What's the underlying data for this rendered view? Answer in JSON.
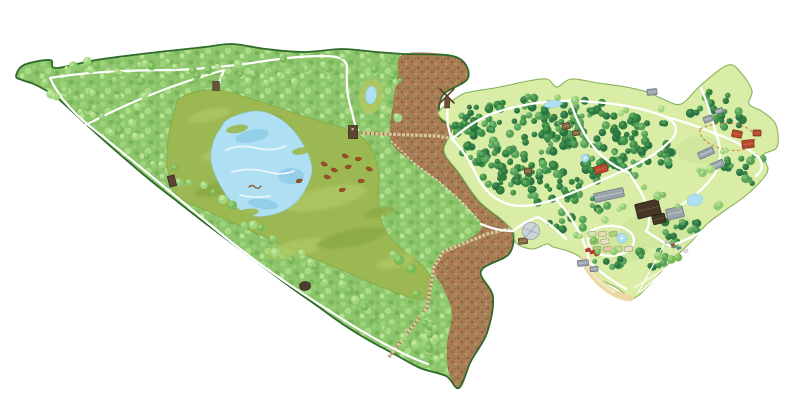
{
  "map": {
    "name": "illustrated-nature-reserve-and-wildlife-park-map",
    "background": "#ffffff",
    "features": [
      {
        "name": "nature-reserve-forest",
        "type": "region"
      },
      {
        "name": "bog-marsh",
        "type": "region"
      },
      {
        "name": "lake",
        "type": "water"
      },
      {
        "name": "forest-pond",
        "type": "water"
      },
      {
        "name": "heathland-clearfelling",
        "type": "region"
      },
      {
        "name": "hiking-trails",
        "type": "trail",
        "count": 4
      },
      {
        "name": "boardwalks",
        "type": "trail",
        "count": 2
      },
      {
        "name": "boundary-fence",
        "type": "barrier",
        "count": 1
      },
      {
        "name": "bird-towers-and-hides",
        "type": "landmark",
        "count": 4
      },
      {
        "name": "grazing-cattle",
        "type": "animals",
        "count": 10
      },
      {
        "name": "flying-bird",
        "type": "animals",
        "count": 1
      },
      {
        "name": "wildlife-park",
        "type": "region"
      },
      {
        "name": "windmill",
        "type": "landmark",
        "count": 1
      },
      {
        "name": "park-buildings",
        "type": "buildings",
        "count": 20
      },
      {
        "name": "park-ponds",
        "type": "water",
        "count": 4
      },
      {
        "name": "formal-garden",
        "type": "area"
      },
      {
        "name": "beach",
        "type": "area"
      },
      {
        "name": "parked-cars",
        "type": "vehicles",
        "count": 4
      },
      {
        "name": "bridle-trail",
        "type": "trail",
        "count": 1
      }
    ],
    "colors": {
      "background": "#ffffff",
      "outline": "#2e6b2a",
      "reserve_forest": "#8cc56b",
      "forest_dots": [
        "#9bd379",
        "#79b65a",
        "#a9db85",
        "#78b457",
        "#b7e393",
        "#97cf74",
        "#86bf63",
        "#8fca70"
      ],
      "marsh": "#9cb852",
      "marsh_light": "#aec762",
      "marsh_dark": "#89a743",
      "water": "#aedff2",
      "water_light": "#e8f6fc",
      "water_mid": "#93cfe9",
      "water_edge": "#8fc7de",
      "heath": "#a87c54",
      "heath_dots": [
        "#8a5c38",
        "#c79e6e",
        "#7d9b52",
        "#b98f60",
        "#95653e"
      ],
      "trail": "#ffffff",
      "park_lawn": "#d9eda6",
      "park_edge": "#86b35c",
      "lawn_patch": "#cde49a",
      "tree_dark_pairs": [
        [
          "#2e7b40",
          "#4f9e52"
        ],
        [
          "#3f8f4b",
          "#63ad5f"
        ],
        [
          "#2a7343",
          "#478f50"
        ],
        [
          "#57a25a",
          "#7cbd72"
        ]
      ],
      "tree_light_pairs": [
        [
          "#8fca70",
          "#b2e093"
        ],
        [
          "#7ab858",
          "#9bd379"
        ],
        [
          "#a2d67f",
          "#c4ea9f"
        ]
      ],
      "boardwalk": "#d9c596",
      "boardwalk_rung": "#8f6f4c",
      "fence": "#ece1c6",
      "roof_red": "#b5492e",
      "roof_red_ridge": "#d0674a",
      "roof_red_stroke": "#7e2e1c",
      "roof_gray": "#9aa2ac",
      "roof_gray_ridge": "#c3cad2",
      "roof_gray_stroke": "#6f757d",
      "roof_dark": "#463626",
      "roof_dark_ridge": "#6a553d",
      "roof_dark_stroke": "#2e2318",
      "roof_brown": "#8a6a46",
      "roof_brown_ridge": "#a98a62",
      "roof_brown_stroke": "#4e3722",
      "hide": "#5d4433",
      "hide_stroke": "#3a2b1f",
      "cattle": "#9c4f26",
      "cattle_stroke": "#6f3417",
      "sand": "#ead9a6",
      "sand_light": "#f2e7c0",
      "bridle_trail": "#d4763b",
      "pavilion": "#ccd3d9",
      "pavilion_stroke": "#97a0a8",
      "car_colors": [
        "#d9d9d9",
        "#c24436",
        "#5577bb",
        "#eeeeee"
      ],
      "bed_colors": [
        "#d4e6ae",
        "#e6d9b4",
        "#a9cf80",
        "#dfc9a2",
        "#c7dd9a",
        "#e8e2c8"
      ],
      "bird": "#8a5a30"
    }
  }
}
